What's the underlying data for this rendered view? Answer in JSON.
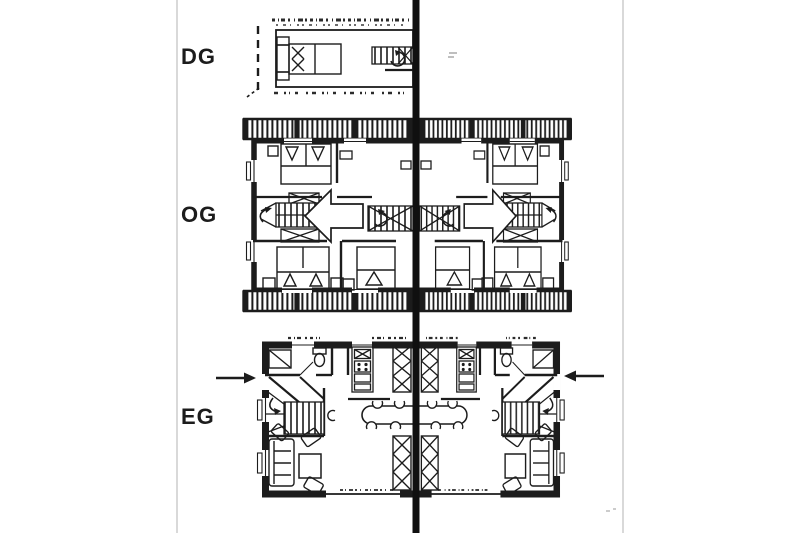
{
  "document": {
    "kind": "scanned-floor-plan",
    "subject": "semi-detached house, mirrored halves, three levels"
  },
  "floors": [
    {
      "id": "dg",
      "label": "DG"
    },
    {
      "id": "og",
      "label": "OG"
    },
    {
      "id": "eg",
      "label": "EG"
    }
  ],
  "arrows": [
    {
      "side": "left",
      "icon": "arrow-right-icon",
      "meaning": "entrance left house"
    },
    {
      "side": "right",
      "icon": "arrow-left-icon",
      "meaning": "entrance right house"
    }
  ],
  "colors": {
    "paper": "#ffffff",
    "ink": "#1c1c1c",
    "frame_line": "#d9d9d9",
    "party_wall_divider": "#101010",
    "scan_gray": "#aaaaaa"
  }
}
